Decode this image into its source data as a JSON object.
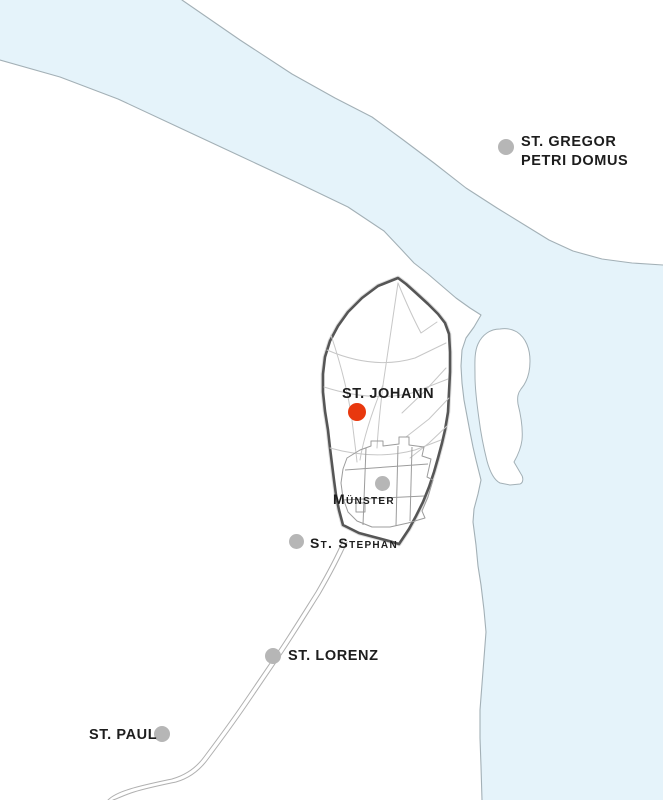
{
  "map": {
    "description": "Historic town map with river, walled old town and church sites",
    "colors": {
      "water": "#e5f3fa",
      "shore": "#a3b0b6",
      "boundary": "#565656",
      "street": "#c7c7c7",
      "building": "#9c9c9c",
      "road": "#b0b0b0",
      "dot": "#b6b6b6",
      "accent": "#e8380e",
      "label": "#1d1d1d"
    },
    "labels": [
      {
        "id": "st-gregor",
        "lines": [
          "ST. GREGOR",
          "PETRI DOMUS"
        ],
        "style": "bold",
        "text_x": 521,
        "text_y": 133,
        "dot": {
          "x": 506,
          "y": 147,
          "color": "gray",
          "d": 16
        }
      },
      {
        "id": "st-johann",
        "lines": [
          "ST. JOHANN"
        ],
        "style": "bold",
        "text_x": 342,
        "text_y": 385,
        "dot": {
          "x": 357,
          "y": 412,
          "color": "red",
          "d": 18
        }
      },
      {
        "id": "muenster",
        "lines": [
          "Münster"
        ],
        "style": "smallcaps",
        "text_x": 333,
        "text_y": 491,
        "dot": {
          "x": 382,
          "y": 483,
          "color": "gray",
          "d": 15
        }
      },
      {
        "id": "st-stephan",
        "lines": [
          "St. Stephan"
        ],
        "style": "smallcaps",
        "text_x": 310,
        "text_y": 535,
        "dot": {
          "x": 296,
          "y": 541,
          "color": "gray",
          "d": 15
        }
      },
      {
        "id": "st-lorenz",
        "lines": [
          "ST. LORENZ"
        ],
        "style": "bold",
        "text_x": 288,
        "text_y": 647,
        "dot": {
          "x": 273,
          "y": 656,
          "color": "gray",
          "d": 16
        }
      },
      {
        "id": "st-paul",
        "lines": [
          "ST. PAUL"
        ],
        "style": "bold",
        "text_x": 89,
        "text_y": 726,
        "dot": {
          "x": 162,
          "y": 734,
          "color": "gray",
          "d": 16
        }
      }
    ]
  }
}
